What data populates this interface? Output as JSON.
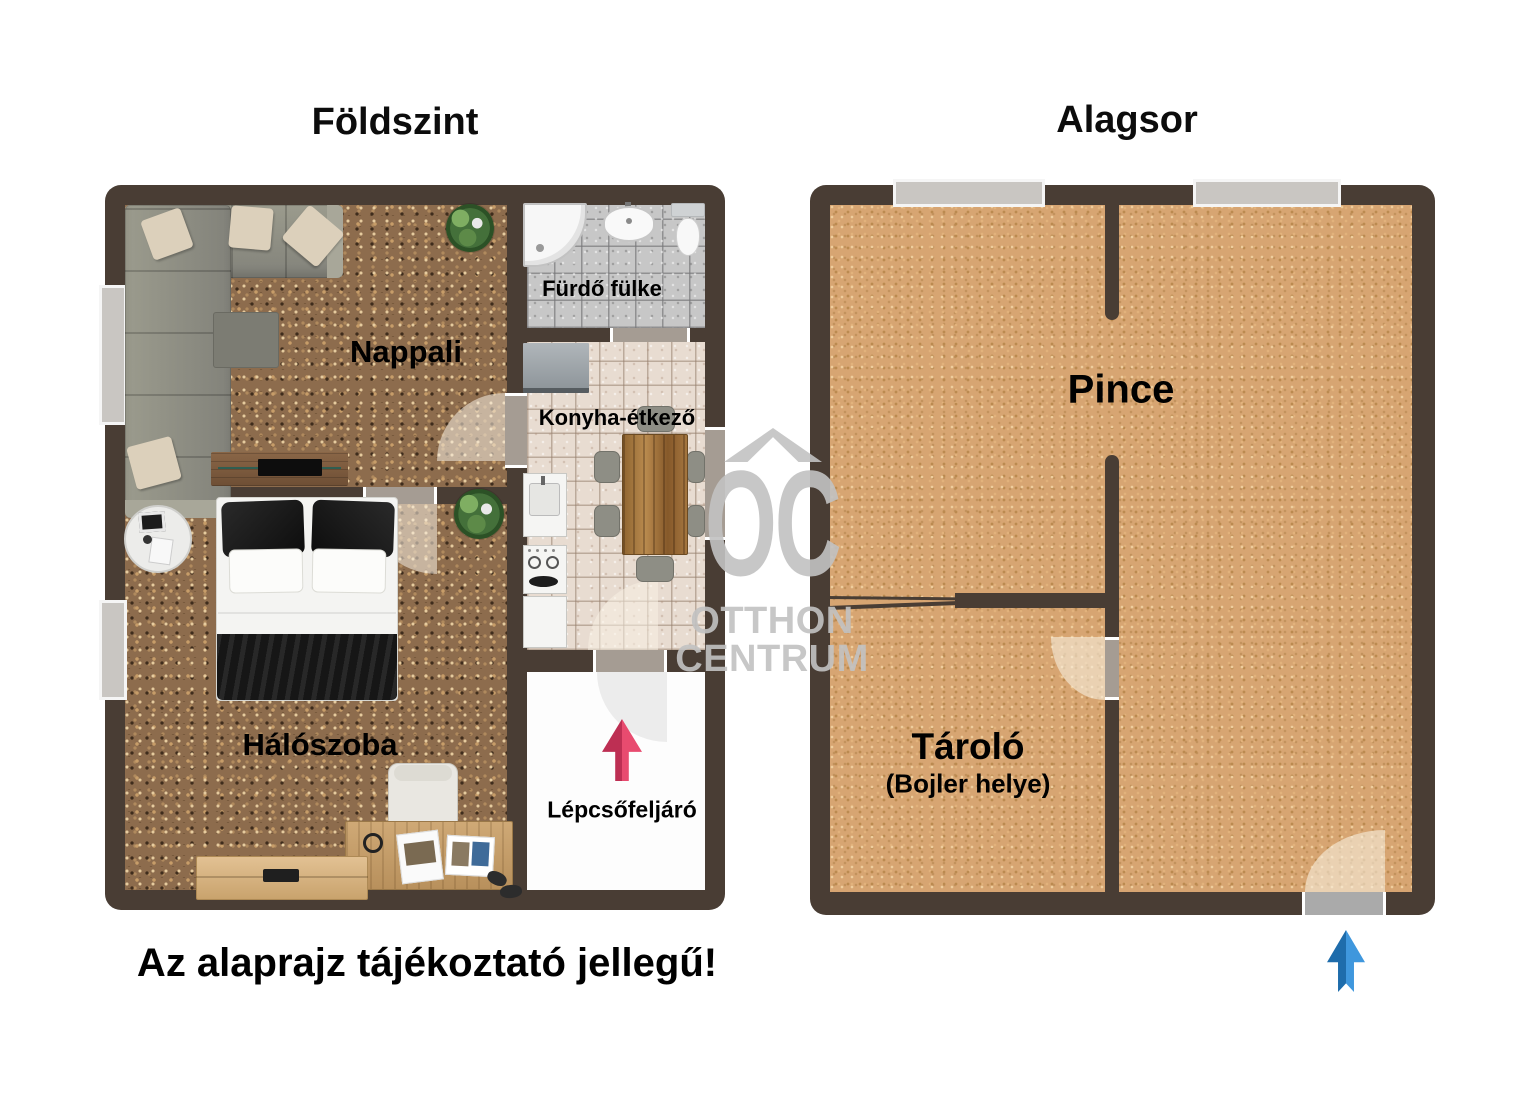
{
  "disclaimer": "Az alaprajz tájékoztató jellegű!",
  "ground_floor": {
    "title": "Földszint",
    "rooms": {
      "living": {
        "label": "Nappali"
      },
      "bathroom": {
        "label": "Fürdő fülke"
      },
      "kitchen": {
        "label": "Konyha-étkező"
      },
      "bedroom": {
        "label": "Hálószoba"
      },
      "stairs": {
        "label": "Lépcsőfeljáró"
      }
    }
  },
  "basement": {
    "title": "Alagsor",
    "rooms": {
      "cellar": {
        "label": "Pince"
      },
      "storage": {
        "label": "Tároló",
        "sublabel": "(Bojler helye)"
      }
    }
  },
  "watermark": {
    "monogram": "OC",
    "name_line1": "OTTHON",
    "name_line2": "CENTRUM"
  },
  "colors": {
    "wall": "#493d34",
    "carpet": "#8d6c4d",
    "basement_floor": "#d7a572",
    "stairs_arrow_red": "#d63d63",
    "entry_arrow_blue": "#2f86c9",
    "watermark_gray": "#c2c2c2"
  }
}
